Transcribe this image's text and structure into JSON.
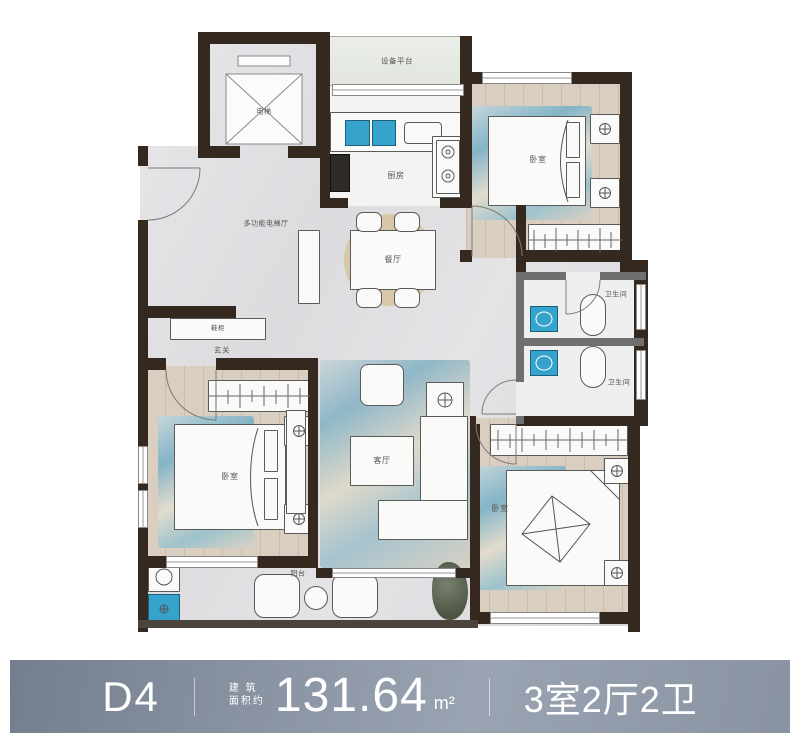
{
  "floor_plan": {
    "rooms": {
      "elevator": "电梯",
      "elevator_hall": "多功能电梯厅",
      "equipment_platform": "设备平台",
      "kitchen": "厨房",
      "bedroom_top_right": "卧室",
      "dining": "餐厅",
      "bathroom_upper": "卫生间",
      "bathroom_lower": "卫生间",
      "shoe_cabinet": "鞋柜",
      "entry": "玄关",
      "bedroom_left": "卧室",
      "living": "客厅",
      "bedroom_bottom_right": "卧室",
      "balcony": "阳台"
    }
  },
  "info_bar": {
    "unit": "D4",
    "area_prefix_line1": "建 筑",
    "area_prefix_line2": "面积约",
    "area_value": "131.64",
    "area_unit": "m²",
    "layout_summary": "3室2厅2卫"
  },
  "colors": {
    "wall_dark": "#35291f",
    "partition_gray": "#6f6f6f",
    "fixture_blue": "#36a3cc",
    "bar_gradient_start": "#747e8d",
    "bar_gradient_end": "#9aa3b1",
    "bar_text": "#ffffff"
  }
}
